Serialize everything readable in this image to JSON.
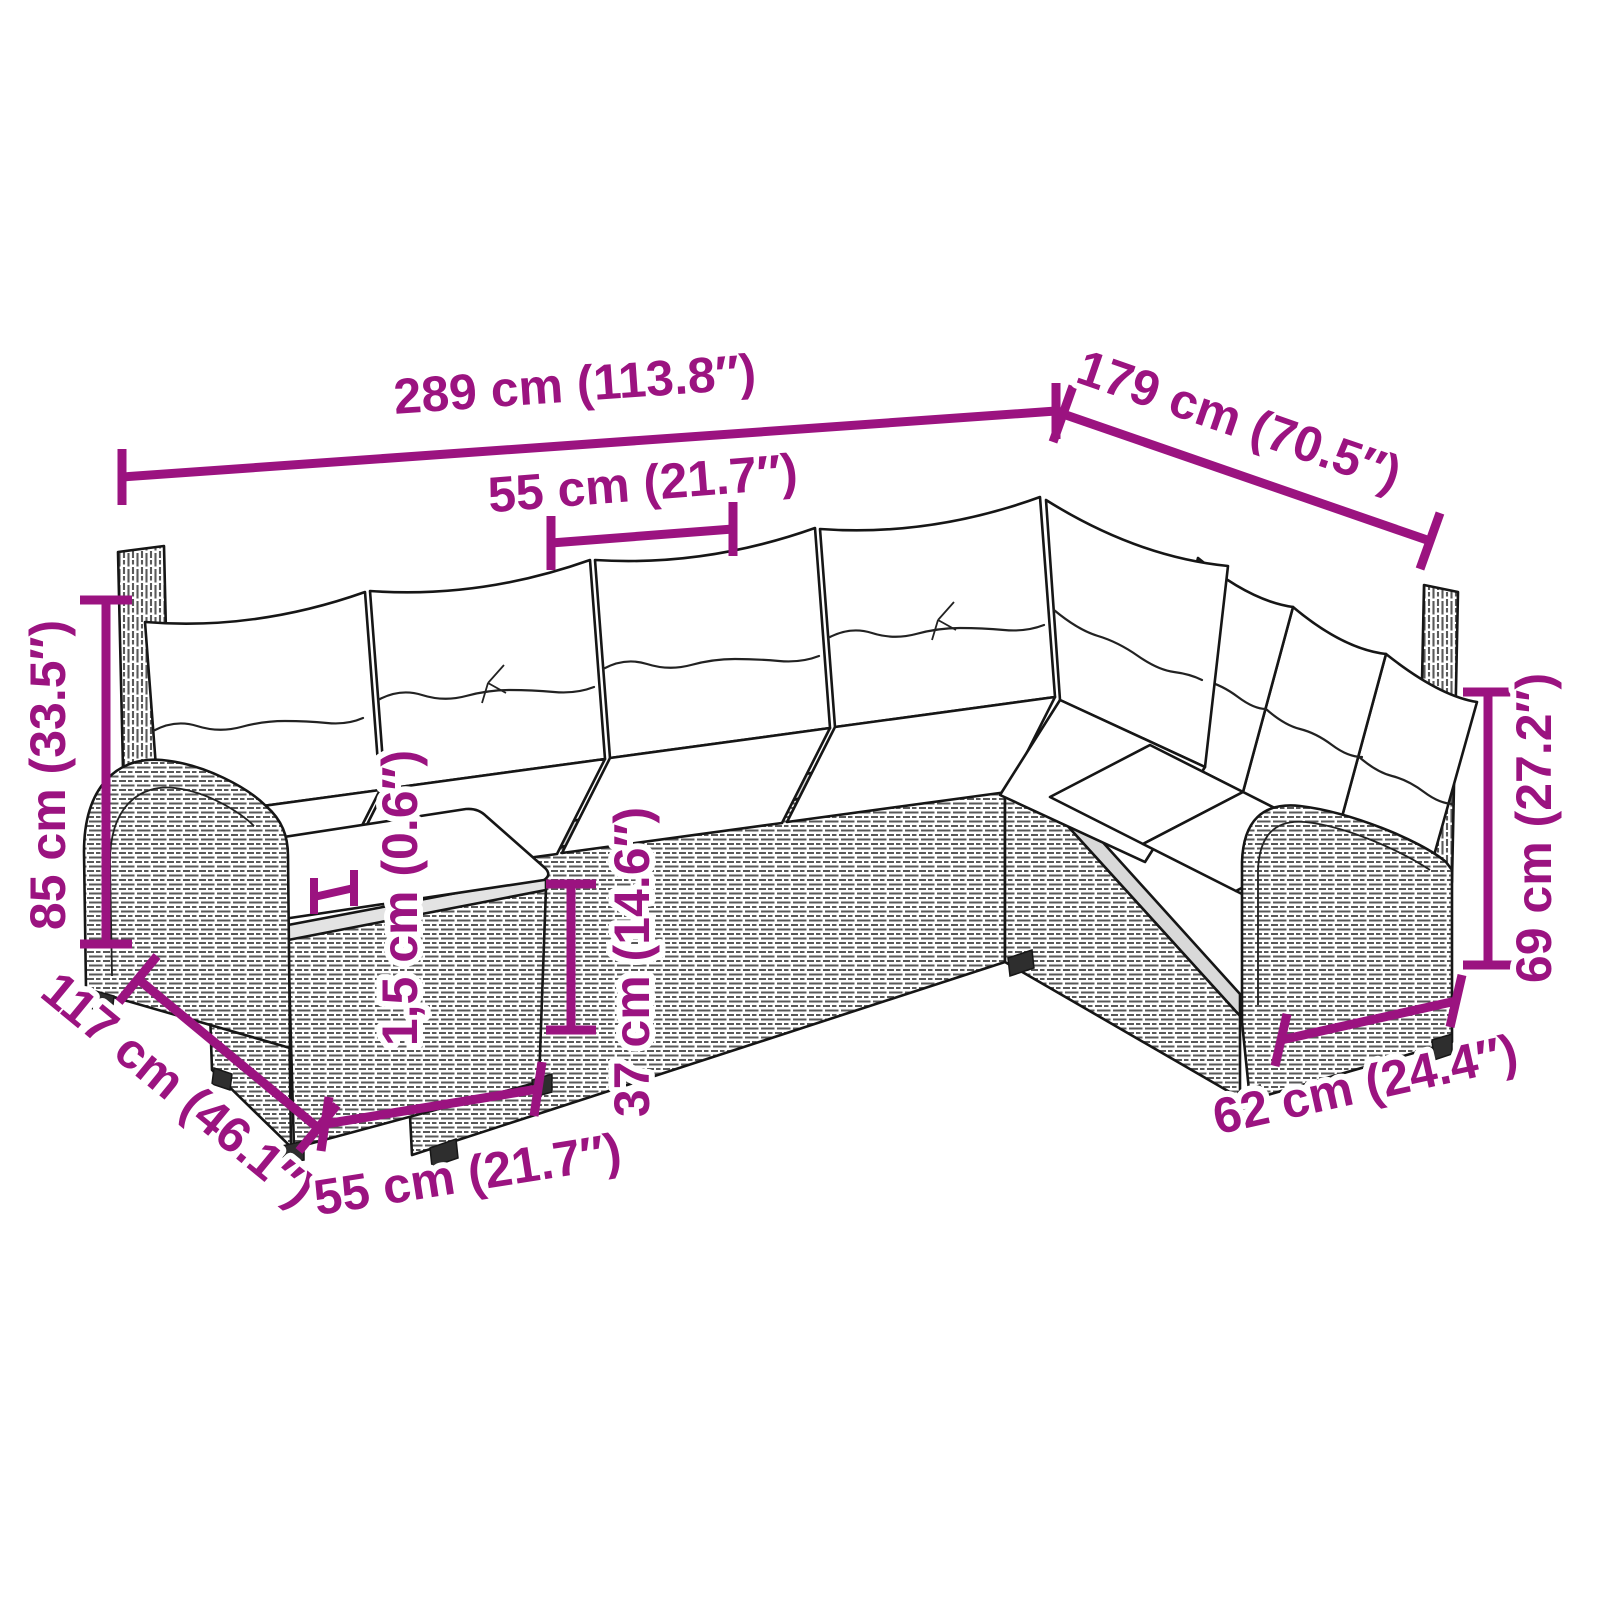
{
  "page": {
    "background": "#ffffff"
  },
  "colors": {
    "dimension_accent": "#9B1380",
    "line_art": "#161616",
    "cushion": "#ffffff"
  },
  "dimensions": {
    "overall_width": "289 cm (113.8″)",
    "right_depth": "179 cm (70.5″)",
    "seat_module_width": "55 cm (21.7″)",
    "overall_height": "85 cm (33.5″)",
    "left_depth": "117 cm (46.1″)",
    "ottoman_width": "55 cm (21.7″)",
    "tabletop_thickness": "1,5 cm (0.6″)",
    "seat_height": "37 cm (14.6″)",
    "armrest_height": "69 cm (27.2″)",
    "right_module_width": "62 cm (24.4″)"
  }
}
